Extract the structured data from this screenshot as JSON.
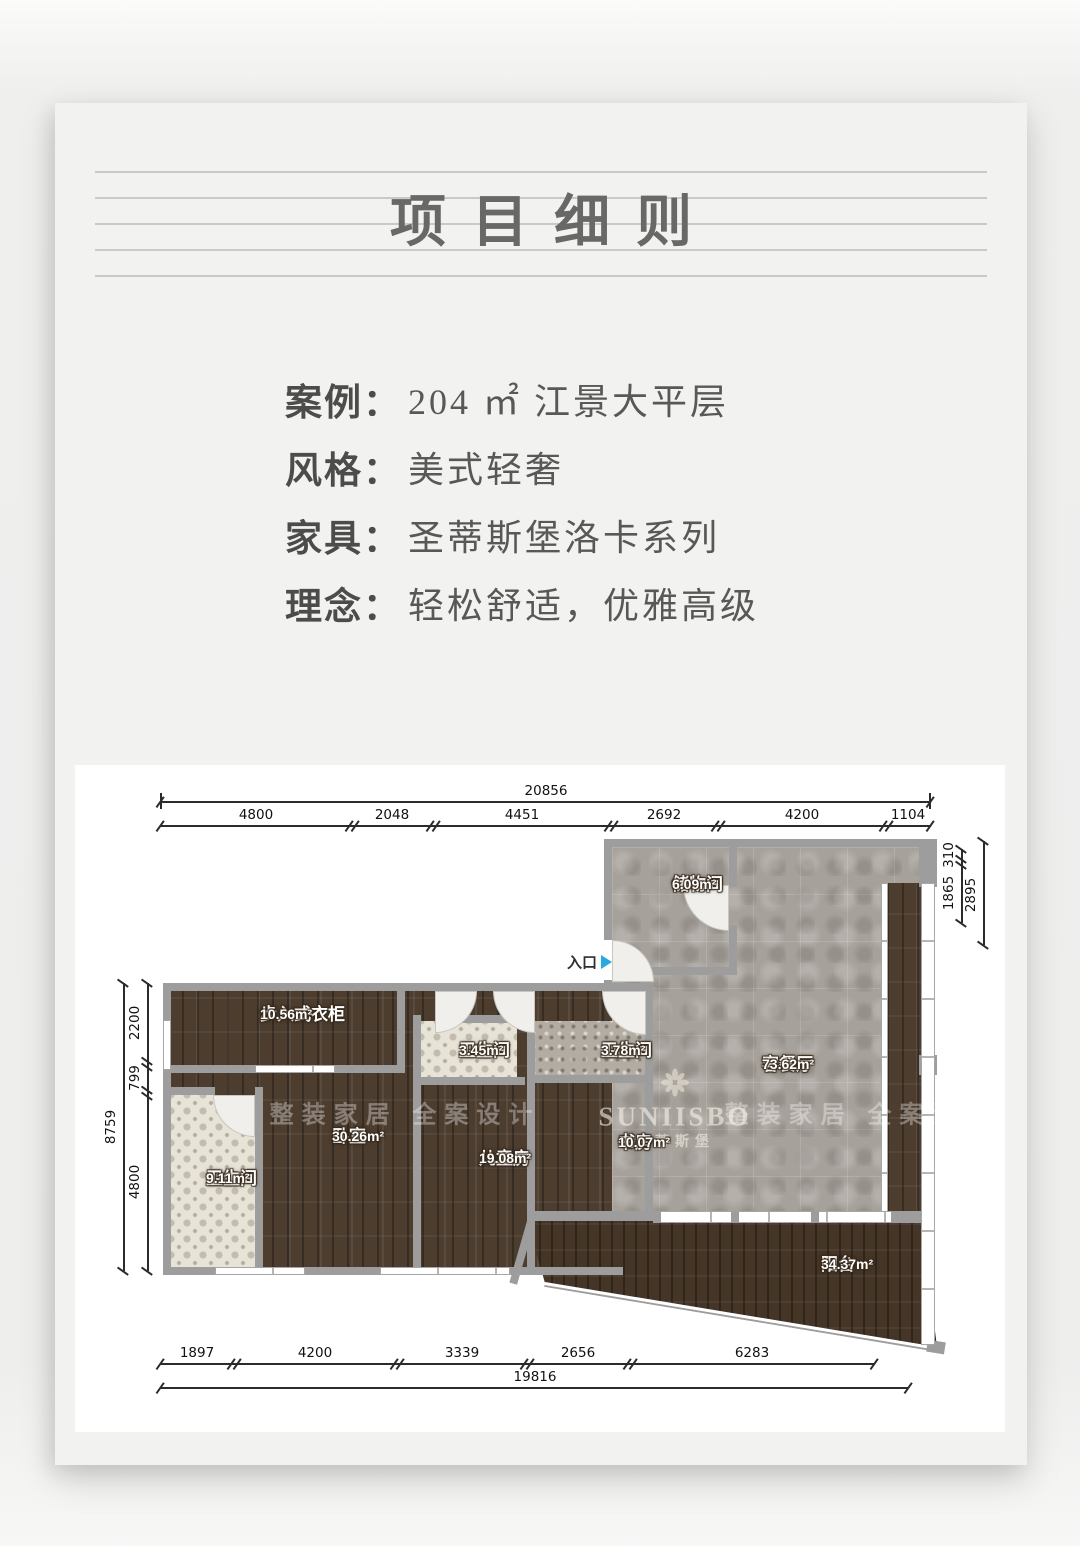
{
  "header": {
    "title": "项目细则"
  },
  "info": {
    "rows": [
      {
        "label": "案例：",
        "value": "204 ㎡ 江景大平层"
      },
      {
        "label": "风格：",
        "value": "美式轻奢"
      },
      {
        "label": "家具：",
        "value": "圣蒂斯堡洛卡系列"
      },
      {
        "label": "理念：",
        "value": "轻松舒适，优雅高级"
      }
    ]
  },
  "plan": {
    "entry_label": "入口",
    "rooms": [
      {
        "name": "储物间",
        "area": "6.09m²"
      },
      {
        "name": "客餐厅",
        "area": "73.62m²"
      },
      {
        "name": "步入式衣柜",
        "area": "10.56m²"
      },
      {
        "name": "卫生间",
        "area": "9.11m²"
      },
      {
        "name": "卧室",
        "area": "30.26m²"
      },
      {
        "name": "卫生间",
        "area": "3.45m²"
      },
      {
        "name": "儿童房",
        "area": "19.08m²"
      },
      {
        "name": "卫生间",
        "area": "3.78m²"
      },
      {
        "name": "书房",
        "area": "10.07m²"
      },
      {
        "name": "阳台",
        "area": "34.37m²"
      }
    ],
    "watermarks": {
      "slogan": "整装家居 全案设计",
      "brand": "SUNIISBO",
      "brand_cn": "圣蒂斯堡"
    },
    "dims": {
      "top": {
        "total": "20856",
        "segments": [
          "4800",
          "2048",
          "4451",
          "2692",
          "4200",
          "1104"
        ]
      },
      "left": {
        "total": "8759",
        "segments": [
          "2200",
          "799",
          "4800"
        ]
      },
      "right": {
        "outer": "2895",
        "segments": [
          "310",
          "1865"
        ]
      },
      "bottom": {
        "total": "19816",
        "segments": [
          "1897",
          "4200",
          "3339",
          "2656",
          "6283"
        ]
      }
    }
  },
  "colors": {
    "entry_arrow": "#2aa8e0",
    "wood": "#4c3d2f",
    "tile": "#a7a19b",
    "wall": "#9d9d9d"
  }
}
